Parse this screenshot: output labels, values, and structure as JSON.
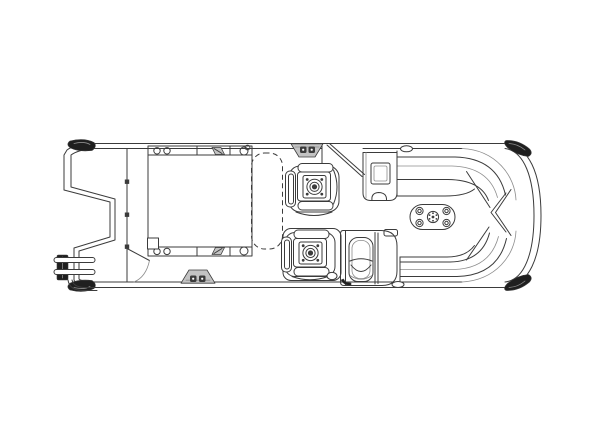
{
  "figure": {
    "alt": "Top-view technical line drawing of a pontoon boat deck plan",
    "background": "#ffffff"
  },
  "palette": {
    "line": "#3b3b3b",
    "line_light": "#8d8d8d",
    "fill_dark": "#1f1f1f",
    "fill_gray": "#c3c3c3",
    "background": "#ffffff"
  },
  "parts": [
    {
      "name": "hull-outline",
      "label": "pontoon deck outline with rounded stern"
    },
    {
      "name": "bow-profile",
      "label": "notched bow platform edge"
    },
    {
      "name": "bow-boarding-ladder",
      "label": "folded boarding ladder at bow"
    },
    {
      "name": "bow-fence-gate",
      "label": "front fence line with hinges and swing door"
    },
    {
      "name": "bow-deck-platform",
      "label": "raised bow platform with flush fittings"
    },
    {
      "name": "optional-lounge-dashed",
      "label": "dashed outline of optional lounge"
    },
    {
      "name": "pedestal-chair-bow",
      "label": "forward swivel pedestal chair"
    },
    {
      "name": "captain-chair",
      "label": "captain swivel chair"
    },
    {
      "name": "helm-console",
      "label": "helm console"
    },
    {
      "name": "port-cabinet",
      "label": "side cabinet with sink"
    },
    {
      "name": "stern-bench-top",
      "label": "wraparound stern lounge, upper"
    },
    {
      "name": "stern-bench-bottom",
      "label": "wraparound stern lounge, lower"
    },
    {
      "name": "stern-table",
      "label": "oval table with cup holders"
    },
    {
      "name": "gate-latch-top",
      "label": "top rail gate step"
    },
    {
      "name": "gate-latch-bottom",
      "label": "bottom rail gate step"
    },
    {
      "name": "corner-caps",
      "label": "dark corner trim caps"
    }
  ]
}
